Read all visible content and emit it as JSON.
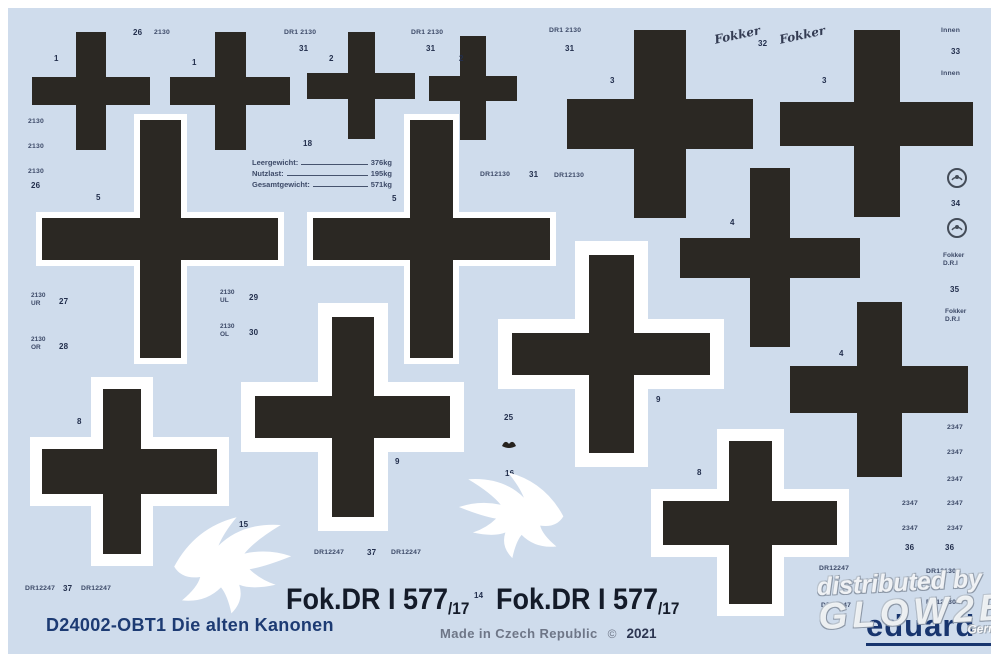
{
  "colors": {
    "sheet_bg": "#cfdcec",
    "cross": "#2b2823",
    "navy": "#1d3b73",
    "label": "#222e4c",
    "code": "#3d4a68"
  },
  "title": "D24002-OBT1 Die alten Kanonen",
  "footer": {
    "made_in": "Made in Czech Republic",
    "copyright": "©",
    "year": "2021"
  },
  "registration": {
    "text": "Fok.DR I 577",
    "suffix": "/17"
  },
  "brand": "eduard",
  "fokker_script": "Fokker",
  "watermark": {
    "line1": "distributed by",
    "line2": "GLOW2B",
    "line3": "Germany"
  },
  "weight_table": {
    "ref_number": "18",
    "rows": [
      {
        "label": "Leergewicht:",
        "value": "376kg"
      },
      {
        "label": "Nutzlast:",
        "value": "195kg"
      },
      {
        "label": "Gesamtgewicht:",
        "value": "571kg"
      }
    ]
  },
  "crosses": [
    {
      "x": 32,
      "y": 32,
      "w": 118,
      "h": 118,
      "va": 30,
      "ha": 28,
      "wb": 0
    },
    {
      "x": 170,
      "y": 32,
      "w": 120,
      "h": 118,
      "va": 31,
      "ha": 28,
      "wb": 0
    },
    {
      "x": 307,
      "y": 32,
      "w": 108,
      "h": 107,
      "va": 27,
      "ha": 26,
      "wb": 0
    },
    {
      "x": 429,
      "y": 36,
      "w": 88,
      "h": 104,
      "va": 26,
      "ha": 25,
      "wb": 0
    },
    {
      "x": 567,
      "y": 30,
      "w": 186,
      "h": 188,
      "va": 52,
      "ha": 50,
      "wb": 0
    },
    {
      "x": 780,
      "y": 30,
      "w": 193,
      "h": 187,
      "va": 46,
      "ha": 44,
      "wb": 0
    },
    {
      "x": 42,
      "y": 120,
      "w": 236,
      "h": 238,
      "va": 41,
      "ha": 42,
      "wb": 6
    },
    {
      "x": 313,
      "y": 120,
      "w": 237,
      "h": 238,
      "va": 43,
      "ha": 42,
      "wb": 6
    },
    {
      "x": 255,
      "y": 317,
      "w": 195,
      "h": 200,
      "va": 42,
      "ha": 42,
      "wb": 14
    },
    {
      "x": 512,
      "y": 255,
      "w": 198,
      "h": 198,
      "va": 45,
      "ha": 42,
      "wb": 14
    },
    {
      "x": 680,
      "y": 168,
      "w": 180,
      "h": 179,
      "va": 40,
      "ha": 40,
      "wb": 0
    },
    {
      "x": 790,
      "y": 302,
      "w": 178,
      "h": 175,
      "va": 45,
      "ha": 47,
      "wb": 0
    },
    {
      "x": 42,
      "y": 389,
      "w": 175,
      "h": 165,
      "va": 38,
      "ha": 45,
      "wb": 12,
      "vdx": -8
    },
    {
      "x": 663,
      "y": 441,
      "w": 174,
      "h": 163,
      "va": 43,
      "ha": 44,
      "wb": 12
    }
  ],
  "labels": [
    {
      "t": "26",
      "x": 133,
      "y": 28
    },
    {
      "t": "2130",
      "x": 154,
      "y": 29,
      "c": "code"
    },
    {
      "t": "1",
      "x": 54,
      "y": 54
    },
    {
      "t": "1",
      "x": 192,
      "y": 58
    },
    {
      "t": "DR1 2130",
      "x": 284,
      "y": 29,
      "c": "code"
    },
    {
      "t": "31",
      "x": 299,
      "y": 44
    },
    {
      "t": "2",
      "x": 329,
      "y": 54
    },
    {
      "t": "DR1 2130",
      "x": 411,
      "y": 29,
      "c": "code"
    },
    {
      "t": "31",
      "x": 426,
      "y": 44
    },
    {
      "t": "2",
      "x": 459,
      "y": 54
    },
    {
      "t": "DR1 2130",
      "x": 549,
      "y": 27,
      "c": "code"
    },
    {
      "t": "31",
      "x": 565,
      "y": 44
    },
    {
      "t": "3",
      "x": 610,
      "y": 76
    },
    {
      "t": "32",
      "x": 758,
      "y": 39
    },
    {
      "t": "3",
      "x": 822,
      "y": 76
    },
    {
      "t": "Innen",
      "x": 941,
      "y": 27,
      "c": "code"
    },
    {
      "t": "33",
      "x": 951,
      "y": 47
    },
    {
      "t": "Innen",
      "x": 941,
      "y": 70,
      "c": "code"
    },
    {
      "t": "2130",
      "x": 28,
      "y": 118,
      "c": "code"
    },
    {
      "t": "2130",
      "x": 28,
      "y": 143,
      "c": "code"
    },
    {
      "t": "2130",
      "x": 28,
      "y": 168,
      "c": "code"
    },
    {
      "t": "26",
      "x": 31,
      "y": 181
    },
    {
      "t": "18",
      "x": 303,
      "y": 139
    },
    {
      "t": "5",
      "x": 96,
      "y": 193
    },
    {
      "t": "5",
      "x": 392,
      "y": 194
    },
    {
      "t": "DR12130",
      "x": 480,
      "y": 171,
      "c": "code"
    },
    {
      "t": "31",
      "x": 529,
      "y": 170
    },
    {
      "t": "DR12130",
      "x": 554,
      "y": 172,
      "c": "code"
    },
    {
      "t": "2130\nUR",
      "x": 31,
      "y": 292,
      "c": "code2"
    },
    {
      "t": "27",
      "x": 59,
      "y": 297
    },
    {
      "t": "2130\nOR",
      "x": 31,
      "y": 336,
      "c": "code2"
    },
    {
      "t": "28",
      "x": 59,
      "y": 342
    },
    {
      "t": "2130\nUL",
      "x": 220,
      "y": 289,
      "c": "code2"
    },
    {
      "t": "29",
      "x": 249,
      "y": 293
    },
    {
      "t": "2130\nOL",
      "x": 220,
      "y": 323,
      "c": "code2"
    },
    {
      "t": "30",
      "x": 249,
      "y": 328
    },
    {
      "t": "34",
      "x": 951,
      "y": 199
    },
    {
      "t": "Fokker\nD.R.I",
      "x": 943,
      "y": 252,
      "c": "code2"
    },
    {
      "t": "35",
      "x": 950,
      "y": 285
    },
    {
      "t": "Fokker\nD.R.I",
      "x": 945,
      "y": 308,
      "c": "code2"
    },
    {
      "t": "4",
      "x": 730,
      "y": 218
    },
    {
      "t": "4",
      "x": 839,
      "y": 349
    },
    {
      "t": "9",
      "x": 395,
      "y": 457
    },
    {
      "t": "9",
      "x": 656,
      "y": 395
    },
    {
      "t": "8",
      "x": 77,
      "y": 417
    },
    {
      "t": "8",
      "x": 697,
      "y": 468
    },
    {
      "t": "25",
      "x": 504,
      "y": 413
    },
    {
      "t": "16",
      "x": 505,
      "y": 469
    },
    {
      "t": "15",
      "x": 239,
      "y": 520
    },
    {
      "t": "2347",
      "x": 947,
      "y": 424,
      "c": "code"
    },
    {
      "t": "2347",
      "x": 947,
      "y": 449,
      "c": "code"
    },
    {
      "t": "2347",
      "x": 947,
      "y": 476,
      "c": "code"
    },
    {
      "t": "2347",
      "x": 902,
      "y": 500,
      "c": "code"
    },
    {
      "t": "2347",
      "x": 947,
      "y": 500,
      "c": "code"
    },
    {
      "t": "2347",
      "x": 902,
      "y": 525,
      "c": "code"
    },
    {
      "t": "2347",
      "x": 947,
      "y": 525,
      "c": "code"
    },
    {
      "t": "36",
      "x": 905,
      "y": 543
    },
    {
      "t": "36",
      "x": 945,
      "y": 543
    },
    {
      "t": "DR12247",
      "x": 314,
      "y": 549,
      "c": "code"
    },
    {
      "t": "37",
      "x": 367,
      "y": 548
    },
    {
      "t": "DR12247",
      "x": 391,
      "y": 549,
      "c": "code"
    },
    {
      "t": "DR12247",
      "x": 25,
      "y": 585,
      "c": "code"
    },
    {
      "t": "37",
      "x": 63,
      "y": 584
    },
    {
      "t": "DR12247",
      "x": 81,
      "y": 585,
      "c": "code"
    },
    {
      "t": "14",
      "x": 474,
      "y": 591
    },
    {
      "t": "DR12247",
      "x": 819,
      "y": 565,
      "c": "code"
    },
    {
      "t": "DR12130",
      "x": 926,
      "y": 568,
      "c": "code"
    },
    {
      "t": "DR12247",
      "x": 821,
      "y": 602,
      "c": "code"
    },
    {
      "t": "DR12130",
      "x": 926,
      "y": 599,
      "c": "code"
    }
  ],
  "eagles": [
    {
      "x": 168,
      "y": 512,
      "w": 132,
      "h": 104,
      "flip": false
    },
    {
      "x": 452,
      "y": 466,
      "w": 116,
      "h": 96,
      "flip": true
    }
  ],
  "roundels": [
    {
      "x": 946,
      "y": 167
    },
    {
      "x": 946,
      "y": 217
    }
  ],
  "glyph": {
    "x": 501,
    "y": 437
  }
}
